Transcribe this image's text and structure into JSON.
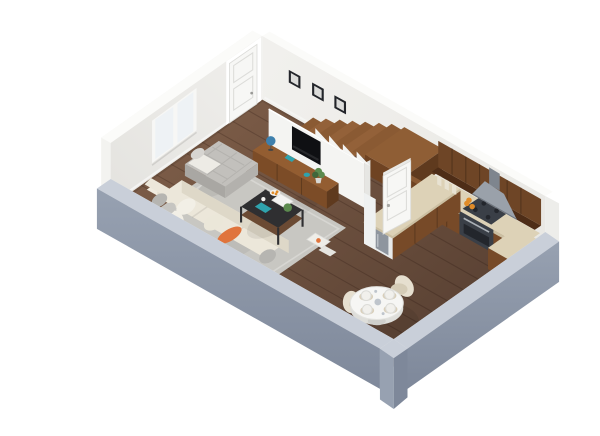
{
  "scene": {
    "name": "3d-apartment-floor-plan-render",
    "view": "isometric cutaway dollhouse view",
    "background": "#ffffff"
  },
  "counts": {
    "picture_frames": 3,
    "stair_treads": 7,
    "dining_chairs": 4,
    "place_settings": 4,
    "window_panes": 2
  },
  "rooms": {
    "living_room": {
      "name": "living-room",
      "items": [
        "cream-sofa",
        "orange-accent-pillow",
        "gray-pillows",
        "gray-quilted-chaise",
        "white-throw",
        "black-coffee-table",
        "serving-tray",
        "books",
        "fruit-plate",
        "gray-area-rug",
        "magazines-on-rug",
        "walnut-tv-console",
        "wall-mounted-tv",
        "desk-globe",
        "houseplant",
        "teal-boxes",
        "two-pane-window",
        "three-picture-frames"
      ]
    },
    "kitchen": {
      "name": "kitchen",
      "items": [
        "walnut-upper-cabinets",
        "walnut-base-cabinets",
        "stone-countertop",
        "range-cooker",
        "range-hood",
        "fruit-on-counter",
        "canisters",
        "peninsula-counter",
        "under-counter-appliance"
      ]
    },
    "dining_area": {
      "name": "dining-area",
      "items": [
        "round-white-pedestal-table",
        "four-cream-wingback-chairs",
        "four-place-settings",
        "woven-placemats",
        "centerpiece"
      ]
    },
    "hallway_stairs": {
      "name": "hallway-and-stairs",
      "items": [
        "wood-staircase",
        "stair-landing",
        "white-stair-stringer-wall",
        "white-interior-door",
        "white-entry-door"
      ]
    }
  },
  "colors": {
    "wall_inner": "#efeeeb",
    "wall_inner_shade": "#e4e3df",
    "wall_inner_right": "#f1f0ed",
    "wall_inner_right_shade": "#e9e8e4",
    "wall_cap": "#fbfbf9",
    "wall_outer_white": "#f3f3f0",
    "wall_cut_top": "#c9cfd9",
    "wall_cut_face": "#97a1b1",
    "wall_cut_face_dark": "#7e889a",
    "wall_end_cap": "#ededea",
    "floor_light": "#7d5d48",
    "floor_dark": "#594133",
    "rug": "#c8c7c2",
    "rug_border": "#d7d6d2",
    "sofa": "#ece7da",
    "sofa_front": "#ded8c8",
    "sofa_back": "#f0ebdf",
    "sofa_backface": "#e3ddcd",
    "pillow_gray": "#b6b5b1",
    "pillow_gray2": "#c6c5c1",
    "pillow_light": "#f2efe6",
    "pillow_light2": "#ebe7d9",
    "orange": "#e0743c",
    "chaise": "#c2c0bc",
    "chaise_side": "#a9a7a3",
    "chaise_side2": "#b3b1ad",
    "chaise_pillow": "#d7d5d1",
    "throw": "#edebe5",
    "table_black": "#2f2f31",
    "table_wood": "#6b4a33",
    "tray": "#f3f3f1",
    "teal": "#2fa3ad",
    "plant": "#5b8a4e",
    "plant_dark": "#40663a",
    "pot": "#d8d8d4",
    "globe": "#3e80ad",
    "console_top": "#935d31",
    "console_front": "#7c4c27",
    "console_side": "#5f3a1e",
    "tv": "#0f1013",
    "partition": "#f4f4f2",
    "partition_edge": "#e6e6e3",
    "stair": "#8a5a33",
    "stair_alt": "#936139",
    "stair_dark": "#6f4322",
    "landing_top": "#8f5e35",
    "door": "#f7f7f5",
    "door_edge": "#dcdcd9",
    "cab_upper": "#6e4526",
    "cab_under": "#4e2d17",
    "cab_base": "#774a28",
    "counter": "#ddd2b7",
    "counter_edge": "#cbbfa2",
    "stove": "#3a3f47",
    "stove_dark": "#23262c",
    "steel": "#aab0b6",
    "hood": "#9aa1aa",
    "hood_dark": "#7e858e",
    "appliance": "#8e959e",
    "pillar": "#eff1f1",
    "fruit": "#e08b28",
    "jar": "#e8e2d2",
    "table_top": "#f6f6f4",
    "table_under": "#dededa",
    "table_base": "#cfcfcb",
    "placemat": "#d9cfba",
    "plate": "#f1f0ec",
    "plate_rim": "#dcdcd8",
    "cup": "#bfc5cc",
    "chair_back": "#e6dfcf",
    "chair_seat": "#d5ccb7",
    "frame": "#23252a",
    "frame_inner": "#dcdcda",
    "glass": "#eef2f5",
    "magazine": "#efeee8",
    "magazine2": "#e6e5e0",
    "bright_opening": "#ffffff"
  }
}
